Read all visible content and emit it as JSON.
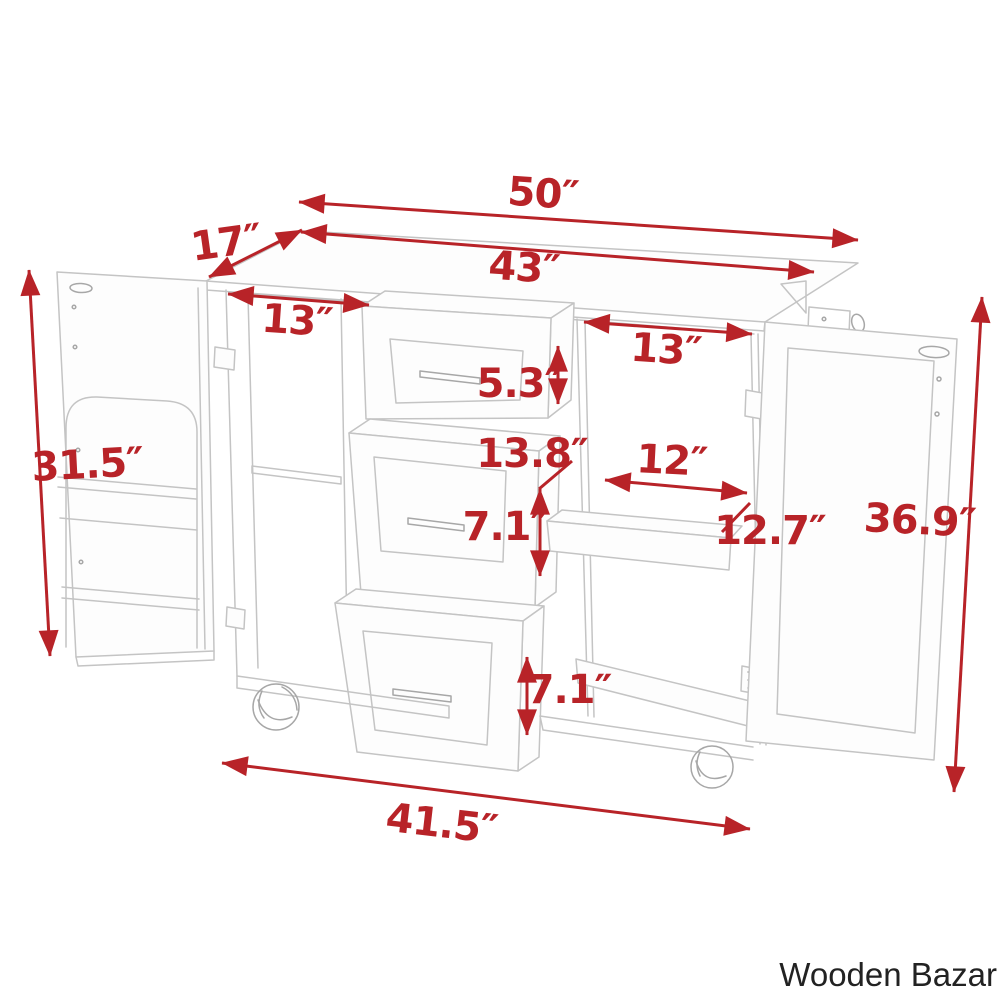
{
  "image_type": "furniture dimension diagram of a kitchen island cart with open doors, three pulled-out drawers, interior shelf and caster wheels",
  "colors": {
    "dimension_red": "#b82328",
    "line_gray": "#c4c4c4",
    "line_gray_dark": "#a7a7a7",
    "watermark_black": "#222222",
    "background": "#ffffff"
  },
  "dimensions": {
    "total_width": "50″",
    "depth": "17″",
    "countertop_width": "43″",
    "left_door_opening": "13″",
    "right_door_opening": "13″",
    "top_drawer_height": "5.3″",
    "drawer_section_height": "13.8″",
    "shelf_depth": "12″",
    "middle_drawer_height": "7.1″",
    "shelf_width": "12.7″",
    "left_side_height": "31.5″",
    "right_side_height": "36.9″",
    "bottom_drawer_height": "7.1″",
    "base_width": "41.5″"
  },
  "brand": {
    "watermark": "Wooden Bazar"
  }
}
